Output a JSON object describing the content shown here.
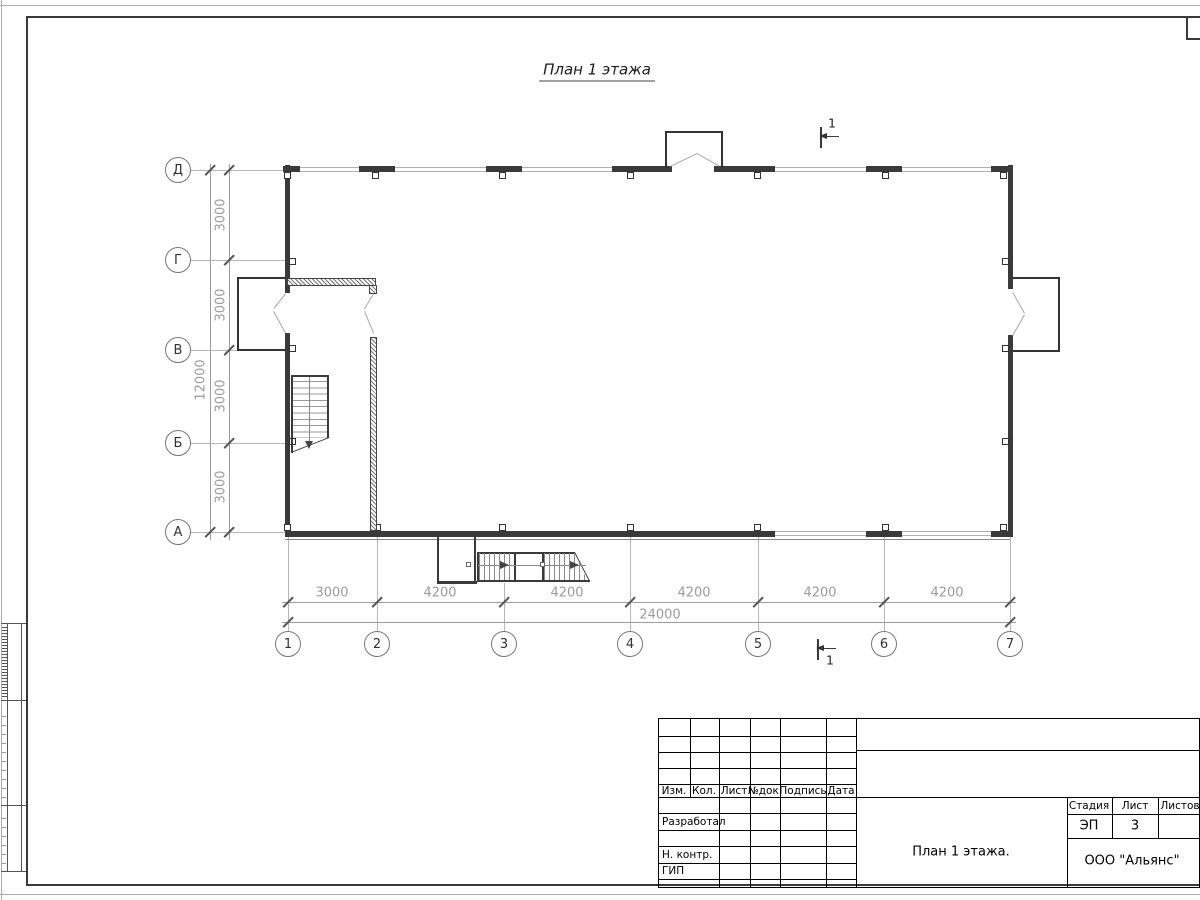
{
  "drawing": {
    "title": "План 1 этажа"
  },
  "axes": {
    "left": [
      "Д",
      "Г",
      "В",
      "Б",
      "А"
    ],
    "bottom": [
      "1",
      "2",
      "3",
      "4",
      "5",
      "6",
      "7"
    ]
  },
  "dims": {
    "v_segments": [
      "3000",
      "3000",
      "3000",
      "3000"
    ],
    "v_total": "12000",
    "h_segments": [
      "3000",
      "4200",
      "4200",
      "4200",
      "4200",
      "4200"
    ],
    "h_total": "24000"
  },
  "section": {
    "number": "1"
  },
  "title_block": {
    "cols": {
      "izm": "Изм.",
      "kol": "Кол.",
      "list": "Лист",
      "doc": "№док.",
      "sign": "Подпись",
      "date": "Дата"
    },
    "roles": {
      "developed": "Разработал",
      "norm": "Н. контр.",
      "gip": "ГИП"
    },
    "stage": {
      "label": "Стадия",
      "value": "ЭП"
    },
    "sheet": {
      "label": "Лист",
      "value": "3"
    },
    "sheets": {
      "label": "Листов",
      "value": ""
    },
    "doc_title": "План 1 этажа.",
    "company": "ООО \"Альянс\""
  }
}
